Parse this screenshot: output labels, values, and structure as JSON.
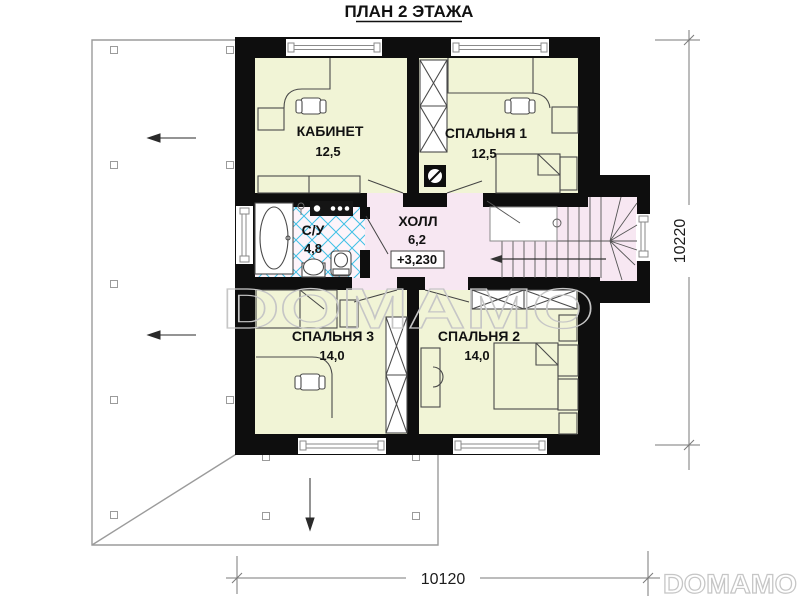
{
  "title": "ПЛАН 2 ЭТАЖА",
  "rooms": {
    "office": {
      "name": "КАБИНЕТ",
      "area": "12,5"
    },
    "bedroom1": {
      "name": "СПАЛЬНЯ 1",
      "area": "12,5"
    },
    "bedroom2": {
      "name": "СПАЛЬНЯ 2",
      "area": "14,0"
    },
    "bedroom3": {
      "name": "СПАЛЬНЯ 3",
      "area": "14,0"
    },
    "hall": {
      "name": "ХОЛЛ",
      "area": "6,2",
      "elevation": "+3,230"
    },
    "bathroom": {
      "name": "С/У",
      "area": "4,8"
    }
  },
  "dimensions": {
    "horizontal": "10120",
    "vertical": "10220"
  },
  "watermarks": {
    "center": "DOMAMO",
    "corner": "DOMAMO"
  },
  "colors": {
    "room_fill": "#f1f4d6",
    "hall_fill": "#f7e7f2",
    "bath_base": "#fdf4fa",
    "tile_line": "#3fc0e6",
    "bath_text": "#1fa8d8",
    "wall": "#0e0e0e",
    "watermark": "#c6c6c6"
  }
}
